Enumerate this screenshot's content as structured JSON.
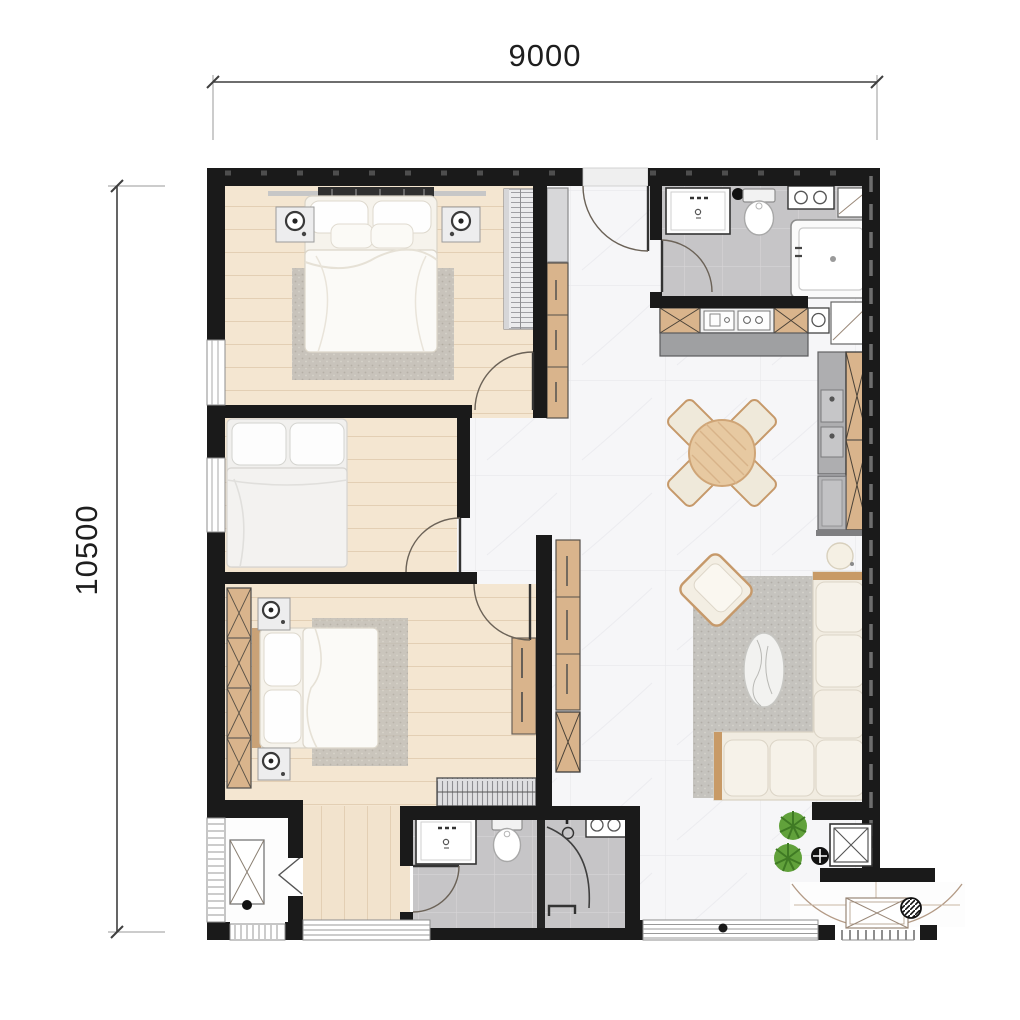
{
  "title": "apartment-floor-plan",
  "dimension_labels": {
    "top_width": "9000",
    "left_height": "10500"
  },
  "colors": {
    "wall": "#1a1a1a",
    "dimension_line": "#3f3f3f",
    "bedroom_wood_floor": "#f4e6d1",
    "living_marble_floor": "#f6f6f8",
    "bathroom_tile_floor": "#c6c5c7",
    "wood_furniture": "#d9b48c",
    "upholstery": "#f3eee3",
    "rug": "#bfbcb6",
    "plant": "#61a13b"
  },
  "rooms": [
    {
      "name": "bedroom-1",
      "furniture": [
        "double-bed",
        "nightstand-left",
        "nightstand-right",
        "rug",
        "striped-wardrobe",
        "swing-door",
        "window"
      ]
    },
    {
      "name": "bedroom-2",
      "furniture": [
        "double-bed",
        "swing-door",
        "window"
      ]
    },
    {
      "name": "bedroom-3",
      "furniture": [
        "double-bed",
        "x-wardrobe",
        "nightstand-top",
        "nightstand-bottom",
        "rug",
        "console",
        "shoe-cabinet",
        "swing-door"
      ]
    },
    {
      "name": "bathroom-1",
      "furniture": [
        "vanity-sink",
        "toilet",
        "bathtub",
        "washer-knob-box",
        "swing-door"
      ]
    },
    {
      "name": "bathroom-2",
      "furniture": [
        "vanity-sink",
        "toilet",
        "shower-enclosure",
        "swing-door"
      ]
    },
    {
      "name": "kitchen",
      "furniture": [
        "counter-cabinets",
        "sink-unit",
        "hob-unit",
        "tall-wood-cabinet",
        "counter-appliances",
        "refrigerator"
      ]
    },
    {
      "name": "dining",
      "furniture": [
        "round-wood-table",
        "chair-x4",
        "side-stool"
      ]
    },
    {
      "name": "living",
      "furniture": [
        "l-shaped-sofa",
        "armchair",
        "oval-coffee-table",
        "rug",
        "wood-console",
        "plant-x2"
      ]
    },
    {
      "name": "hall",
      "furniture": [
        "entry-swing-door",
        "tall-cabinet"
      ]
    },
    {
      "name": "entrance-lobby",
      "furniture": [
        "double-entry-doors",
        "x-doormat",
        "hatched-column",
        "shaft-box",
        "comb-threshold"
      ]
    },
    {
      "name": "ac-ledge",
      "furniture": [
        "ac-unit",
        "louver-door"
      ]
    }
  ]
}
